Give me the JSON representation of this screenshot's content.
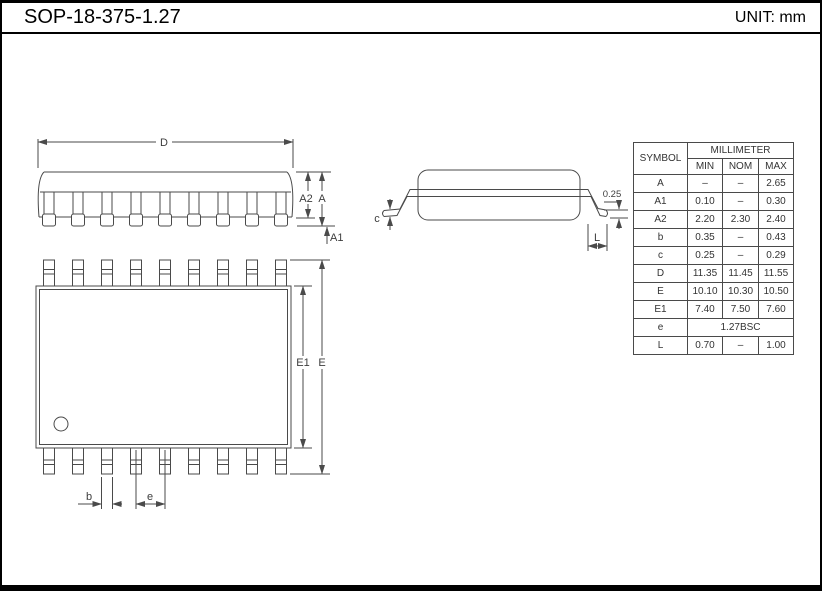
{
  "header": {
    "title": "SOP-18-375-1.27",
    "unit_label": "UNIT: mm"
  },
  "drawing": {
    "labels": {
      "D": "D",
      "A": "A",
      "A2": "A2",
      "A1": "A1",
      "E": "E",
      "E1": "E1",
      "b": "b",
      "e": "e",
      "c": "c",
      "L": "L",
      "gauge": "0.25"
    },
    "pins_per_side": 9,
    "line_color": "#4a4a4a"
  },
  "table": {
    "symbol_header": "SYMBOL",
    "unit_header": "MILLIMETER",
    "col_headers": [
      "MIN",
      "NOM",
      "MAX"
    ],
    "rows": [
      {
        "symbol": "A",
        "min": "–",
        "nom": "–",
        "max": "2.65"
      },
      {
        "symbol": "A1",
        "min": "0.10",
        "nom": "–",
        "max": "0.30"
      },
      {
        "symbol": "A2",
        "min": "2.20",
        "nom": "2.30",
        "max": "2.40"
      },
      {
        "symbol": "b",
        "min": "0.35",
        "nom": "–",
        "max": "0.43"
      },
      {
        "symbol": "c",
        "min": "0.25",
        "nom": "–",
        "max": "0.29"
      },
      {
        "symbol": "D",
        "min": "11.35",
        "nom": "11.45",
        "max": "11.55"
      },
      {
        "symbol": "E",
        "min": "10.10",
        "nom": "10.30",
        "max": "10.50"
      },
      {
        "symbol": "E1",
        "min": "7.40",
        "nom": "7.50",
        "max": "7.60"
      },
      {
        "symbol": "e",
        "span": "1.27BSC"
      },
      {
        "symbol": "L",
        "min": "0.70",
        "nom": "–",
        "max": "1.00"
      }
    ]
  }
}
